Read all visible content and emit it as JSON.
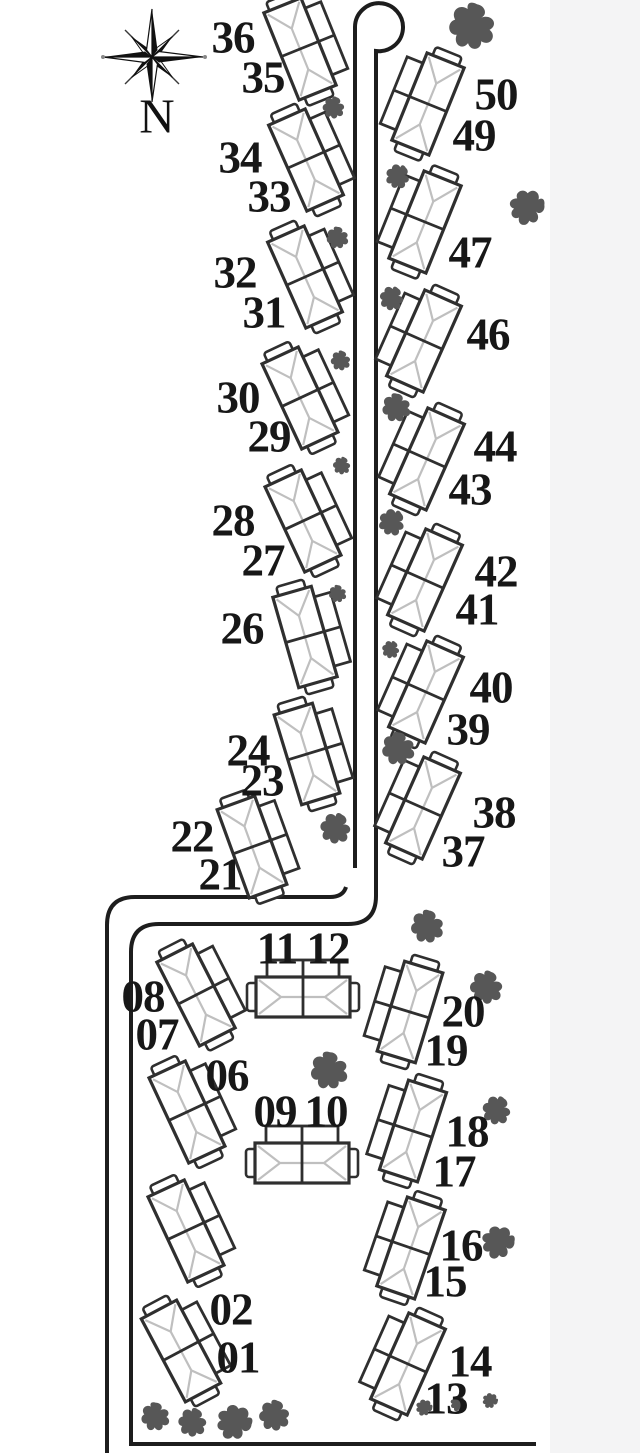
{
  "title": "Site map with numbered duplex units, access road, cul-de-sac and trees",
  "compass": {
    "label": "N"
  },
  "colors": {
    "background": "#ffffff",
    "scan_margin": "#f4f4f5",
    "road_line": "#1d1d1d",
    "building_outline": "#2f2f2f",
    "roof_ridge_line": "#bfbfbf",
    "tree": "#575757",
    "label_text": "#171717"
  },
  "map": {
    "unit_labels": [
      {
        "text": "36",
        "x": 233,
        "y": 38
      },
      {
        "text": "35",
        "x": 263,
        "y": 78
      },
      {
        "text": "34",
        "x": 240,
        "y": 158
      },
      {
        "text": "33",
        "x": 269,
        "y": 197
      },
      {
        "text": "32",
        "x": 235,
        "y": 273
      },
      {
        "text": "31",
        "x": 264,
        "y": 313
      },
      {
        "text": "30",
        "x": 238,
        "y": 398
      },
      {
        "text": "29",
        "x": 269,
        "y": 437
      },
      {
        "text": "28",
        "x": 233,
        "y": 521
      },
      {
        "text": "27",
        "x": 263,
        "y": 561
      },
      {
        "text": "26",
        "x": 242,
        "y": 629
      },
      {
        "text": "24",
        "x": 248,
        "y": 751
      },
      {
        "text": "23",
        "x": 262,
        "y": 781
      },
      {
        "text": "22",
        "x": 192,
        "y": 837
      },
      {
        "text": "21",
        "x": 220,
        "y": 875
      },
      {
        "text": "50",
        "x": 496,
        "y": 95
      },
      {
        "text": "49",
        "x": 474,
        "y": 136
      },
      {
        "text": "47",
        "x": 470,
        "y": 253
      },
      {
        "text": "46",
        "x": 488,
        "y": 335
      },
      {
        "text": "44",
        "x": 495,
        "y": 447
      },
      {
        "text": "43",
        "x": 470,
        "y": 490
      },
      {
        "text": "42",
        "x": 496,
        "y": 572
      },
      {
        "text": "41",
        "x": 477,
        "y": 610
      },
      {
        "text": "40",
        "x": 491,
        "y": 688
      },
      {
        "text": "39",
        "x": 468,
        "y": 730
      },
      {
        "text": "38",
        "x": 494,
        "y": 813
      },
      {
        "text": "37",
        "x": 463,
        "y": 852
      },
      {
        "text": "11",
        "x": 277,
        "y": 949
      },
      {
        "text": "12",
        "x": 328,
        "y": 949
      },
      {
        "text": "08",
        "x": 143,
        "y": 997
      },
      {
        "text": "07",
        "x": 157,
        "y": 1035
      },
      {
        "text": "06",
        "x": 227,
        "y": 1076
      },
      {
        "text": "09",
        "x": 275,
        "y": 1112
      },
      {
        "text": "10",
        "x": 326,
        "y": 1112
      },
      {
        "text": "20",
        "x": 463,
        "y": 1012
      },
      {
        "text": "19",
        "x": 446,
        "y": 1051
      },
      {
        "text": "18",
        "x": 467,
        "y": 1132
      },
      {
        "text": "17",
        "x": 454,
        "y": 1172
      },
      {
        "text": "16",
        "x": 461,
        "y": 1246
      },
      {
        "text": "15",
        "x": 445,
        "y": 1282
      },
      {
        "text": "02",
        "x": 231,
        "y": 1310
      },
      {
        "text": "01",
        "x": 238,
        "y": 1358
      },
      {
        "text": "14",
        "x": 470,
        "y": 1362
      },
      {
        "text": "13",
        "x": 446,
        "y": 1399
      }
    ],
    "buildings": [
      {
        "units": "35-36",
        "x": 300,
        "y": 49,
        "rot": 68
      },
      {
        "units": "33-34",
        "x": 306,
        "y": 160,
        "rot": 66
      },
      {
        "units": "31-32",
        "x": 305,
        "y": 277,
        "rot": 66
      },
      {
        "units": "29-30",
        "x": 300,
        "y": 398,
        "rot": 65
      },
      {
        "units": "27-28",
        "x": 303,
        "y": 521,
        "rot": 65
      },
      {
        "units": "26",
        "x": 305,
        "y": 637,
        "rot": 74
      },
      {
        "units": "23-24",
        "x": 307,
        "y": 754,
        "rot": 73
      },
      {
        "units": "21-22",
        "x": 252,
        "y": 847,
        "rot": 70
      },
      {
        "units": "49-50",
        "x": 428,
        "y": 104,
        "rot": -68
      },
      {
        "units": "47",
        "x": 425,
        "y": 222,
        "rot": -68
      },
      {
        "units": "46",
        "x": 424,
        "y": 341,
        "rot": -66
      },
      {
        "units": "43-44",
        "x": 427,
        "y": 459,
        "rot": -66
      },
      {
        "units": "41-42",
        "x": 425,
        "y": 580,
        "rot": -66
      },
      {
        "units": "39-40",
        "x": 426,
        "y": 692,
        "rot": -66
      },
      {
        "units": "37-38",
        "x": 423,
        "y": 808,
        "rot": -66
      },
      {
        "units": "07-08",
        "x": 196,
        "y": 995,
        "rot": 63
      },
      {
        "units": "11-12",
        "x": 303,
        "y": 997,
        "rot": 0
      },
      {
        "units": "06",
        "x": 187,
        "y": 1112,
        "rot": 65
      },
      {
        "units": "09-10",
        "x": 302,
        "y": 1163,
        "rot": 0
      },
      {
        "units": "unlabeled",
        "x": 186,
        "y": 1231,
        "rot": 65
      },
      {
        "units": "01-02",
        "x": 181,
        "y": 1351,
        "rot": 62
      },
      {
        "units": "19-20",
        "x": 410,
        "y": 1012,
        "rot": -73
      },
      {
        "units": "17-18",
        "x": 413,
        "y": 1131,
        "rot": -72
      },
      {
        "units": "15-16",
        "x": 411,
        "y": 1248,
        "rot": -71
      },
      {
        "units": "13-14",
        "x": 408,
        "y": 1364,
        "rot": -66
      }
    ],
    "trees": [
      {
        "x": 473,
        "y": 27,
        "s": 2.1,
        "r": 10
      },
      {
        "x": 334,
        "y": 108,
        "s": 1.0,
        "r": 15
      },
      {
        "x": 398,
        "y": 177,
        "s": 1.1,
        "r": 40
      },
      {
        "x": 527,
        "y": 208,
        "s": 1.6,
        "r": 80
      },
      {
        "x": 338,
        "y": 238,
        "s": 1.0,
        "r": 0
      },
      {
        "x": 392,
        "y": 299,
        "s": 1.1,
        "r": 30
      },
      {
        "x": 341,
        "y": 361,
        "s": 0.9,
        "r": 10
      },
      {
        "x": 397,
        "y": 408,
        "s": 1.3,
        "r": 0
      },
      {
        "x": 342,
        "y": 466,
        "s": 0.8,
        "r": 20
      },
      {
        "x": 392,
        "y": 523,
        "s": 1.2,
        "r": 45
      },
      {
        "x": 338,
        "y": 594,
        "s": 0.8,
        "r": 0
      },
      {
        "x": 391,
        "y": 650,
        "s": 0.8,
        "r": 30
      },
      {
        "x": 399,
        "y": 749,
        "s": 1.5,
        "r": 0
      },
      {
        "x": 336,
        "y": 829,
        "s": 1.4,
        "r": 25
      },
      {
        "x": 428,
        "y": 927,
        "s": 1.5,
        "r": 5
      },
      {
        "x": 487,
        "y": 988,
        "s": 1.5,
        "r": 15
      },
      {
        "x": 330,
        "y": 1071,
        "s": 1.7,
        "r": 0
      },
      {
        "x": 497,
        "y": 1111,
        "s": 1.3,
        "r": 30
      },
      {
        "x": 498,
        "y": 1243,
        "s": 1.5,
        "r": 85
      },
      {
        "x": 156,
        "y": 1417,
        "s": 1.3,
        "r": 0
      },
      {
        "x": 193,
        "y": 1423,
        "s": 1.3,
        "r": 20
      },
      {
        "x": 234,
        "y": 1423,
        "s": 1.6,
        "r": 95
      },
      {
        "x": 275,
        "y": 1416,
        "s": 1.4,
        "r": 10
      },
      {
        "x": 424,
        "y": 1408,
        "s": 0.75,
        "r": 90
      },
      {
        "x": 458,
        "y": 1404,
        "s": 0.7,
        "r": 85
      },
      {
        "x": 490,
        "y": 1401,
        "s": 0.7,
        "r": 95
      }
    ]
  }
}
